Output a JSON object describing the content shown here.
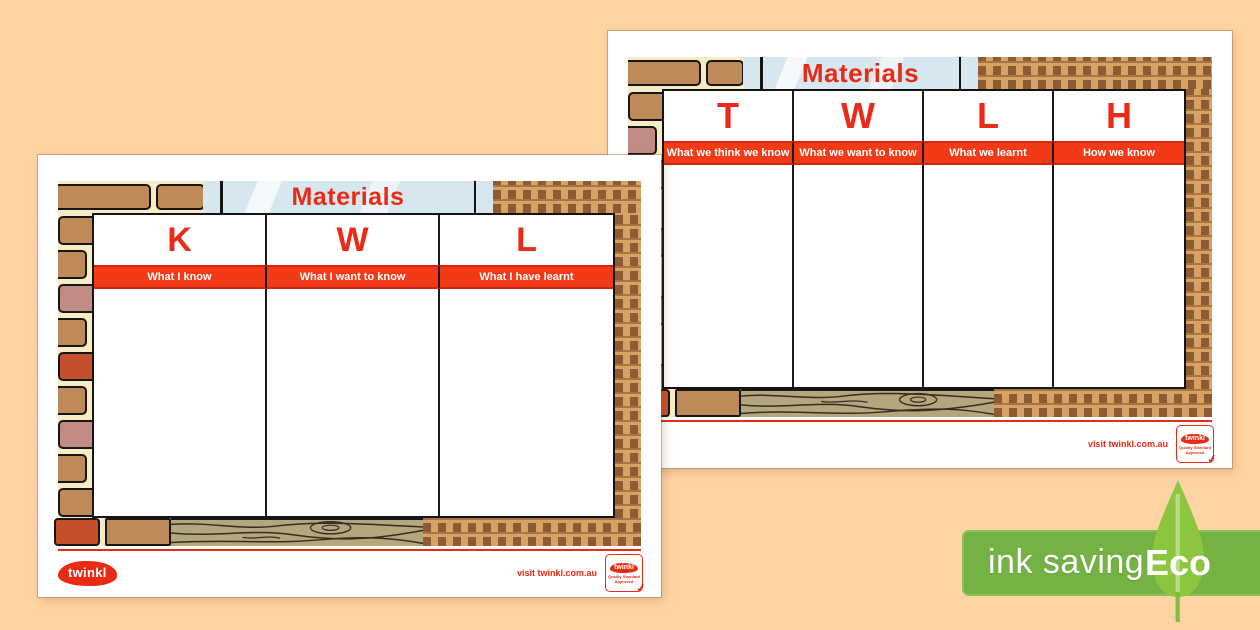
{
  "canvas": {
    "background_color": "#FFD4A4"
  },
  "colors": {
    "accent_red": "#E92B15",
    "subtitle_bar_red": "#F23B16",
    "glass_blue": "#D6E7F0",
    "brick_tan": "#BE8A58",
    "brick_pink": "#C08C85",
    "brick_orange": "#C4512B",
    "mortar_cream": "#F7ECC5",
    "wood_olive": "#B2A77D",
    "eco_banner_green": "#74B243",
    "eco_leaf_green": "#8CC63F"
  },
  "pages": [
    {
      "name": "twlh-chart-back-page",
      "title": "Materials",
      "columns": [
        {
          "letter": "T",
          "subtitle": "What we think we know"
        },
        {
          "letter": "W",
          "subtitle": "What we want to know"
        },
        {
          "letter": "L",
          "subtitle": "What we learnt"
        },
        {
          "letter": "H",
          "subtitle": "How we know"
        }
      ],
      "footer": {
        "site": "visit twinkl.com.au"
      }
    },
    {
      "name": "kwl-chart-front-page",
      "title": "Materials",
      "columns": [
        {
          "letter": "K",
          "subtitle": "What I know"
        },
        {
          "letter": "W",
          "subtitle": "What I want to know"
        },
        {
          "letter": "L",
          "subtitle": "What I have learnt"
        }
      ],
      "footer": {
        "logo": "twinkl",
        "site": "visit twinkl.com.au"
      }
    }
  ],
  "stamp": {
    "logo": "twinkl",
    "text": "Quality Standard Approved",
    "check": "✓"
  },
  "eco_badge": {
    "label": "ink saving",
    "leaf_label": "Eco"
  }
}
